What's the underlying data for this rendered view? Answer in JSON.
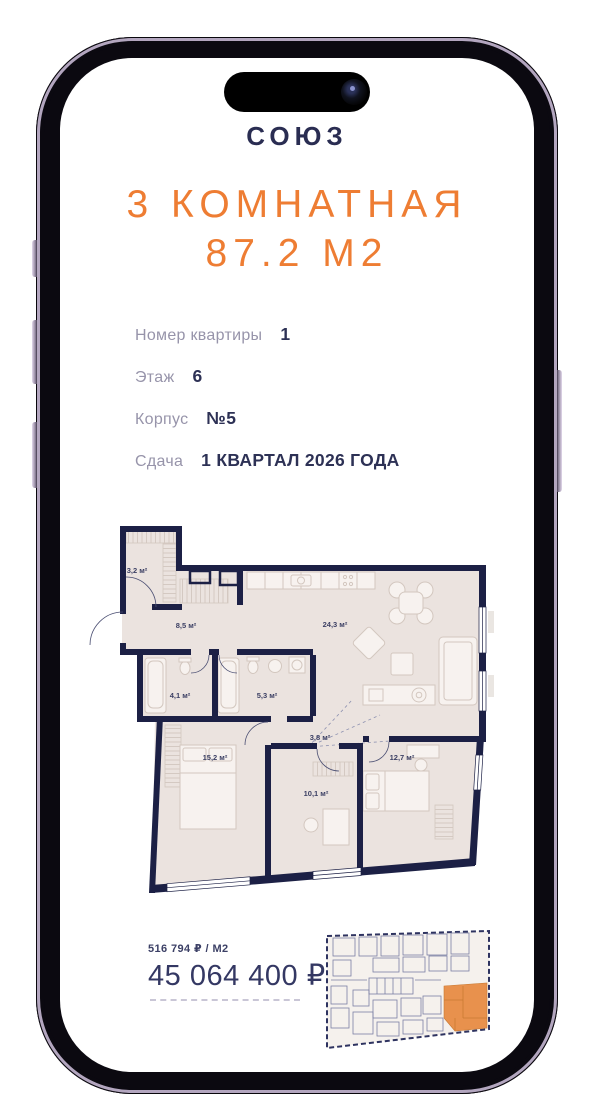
{
  "device": {
    "type": "iphone-mockup"
  },
  "brand": {
    "logo_text": "СОЮЗ"
  },
  "listing": {
    "title_line1": "3 КОМНАТНАЯ",
    "title_line2": "87.2 М2",
    "details": [
      {
        "label": "Номер квартиры",
        "value": "1"
      },
      {
        "label": "Этаж",
        "value": "6"
      },
      {
        "label": "Корпус",
        "value": "№5"
      },
      {
        "label": "Сдача",
        "value": "1 КВАРТАЛ 2026 ГОДА"
      }
    ],
    "price_per_m2": "516 794 ₽ / М2",
    "price_total": "45 064 400 ₽"
  },
  "floor_plan": {
    "rooms": [
      {
        "name": "closet",
        "area_label": "3,2 м²"
      },
      {
        "name": "hallway",
        "area_label": "8,5 м²"
      },
      {
        "name": "kitchen-living-room",
        "area_label": "24,3 м²"
      },
      {
        "name": "bathroom",
        "area_label": "4,1 м²"
      },
      {
        "name": "bathroom-2",
        "area_label": "5,3 м²"
      },
      {
        "name": "corridor",
        "area_label": "3,8 м²"
      },
      {
        "name": "bedroom",
        "area_label": "15,2 м²"
      },
      {
        "name": "room",
        "area_label": "10,1 м²"
      },
      {
        "name": "bedroom-2",
        "area_label": "12,7 м²"
      }
    ]
  },
  "colors": {
    "accent_orange": "#ee7d33",
    "navy_text": "#2d3155",
    "plan_wall": "#1c2045",
    "plan_floor": "#ebe3df",
    "highlight_unit": "#e8914d"
  }
}
